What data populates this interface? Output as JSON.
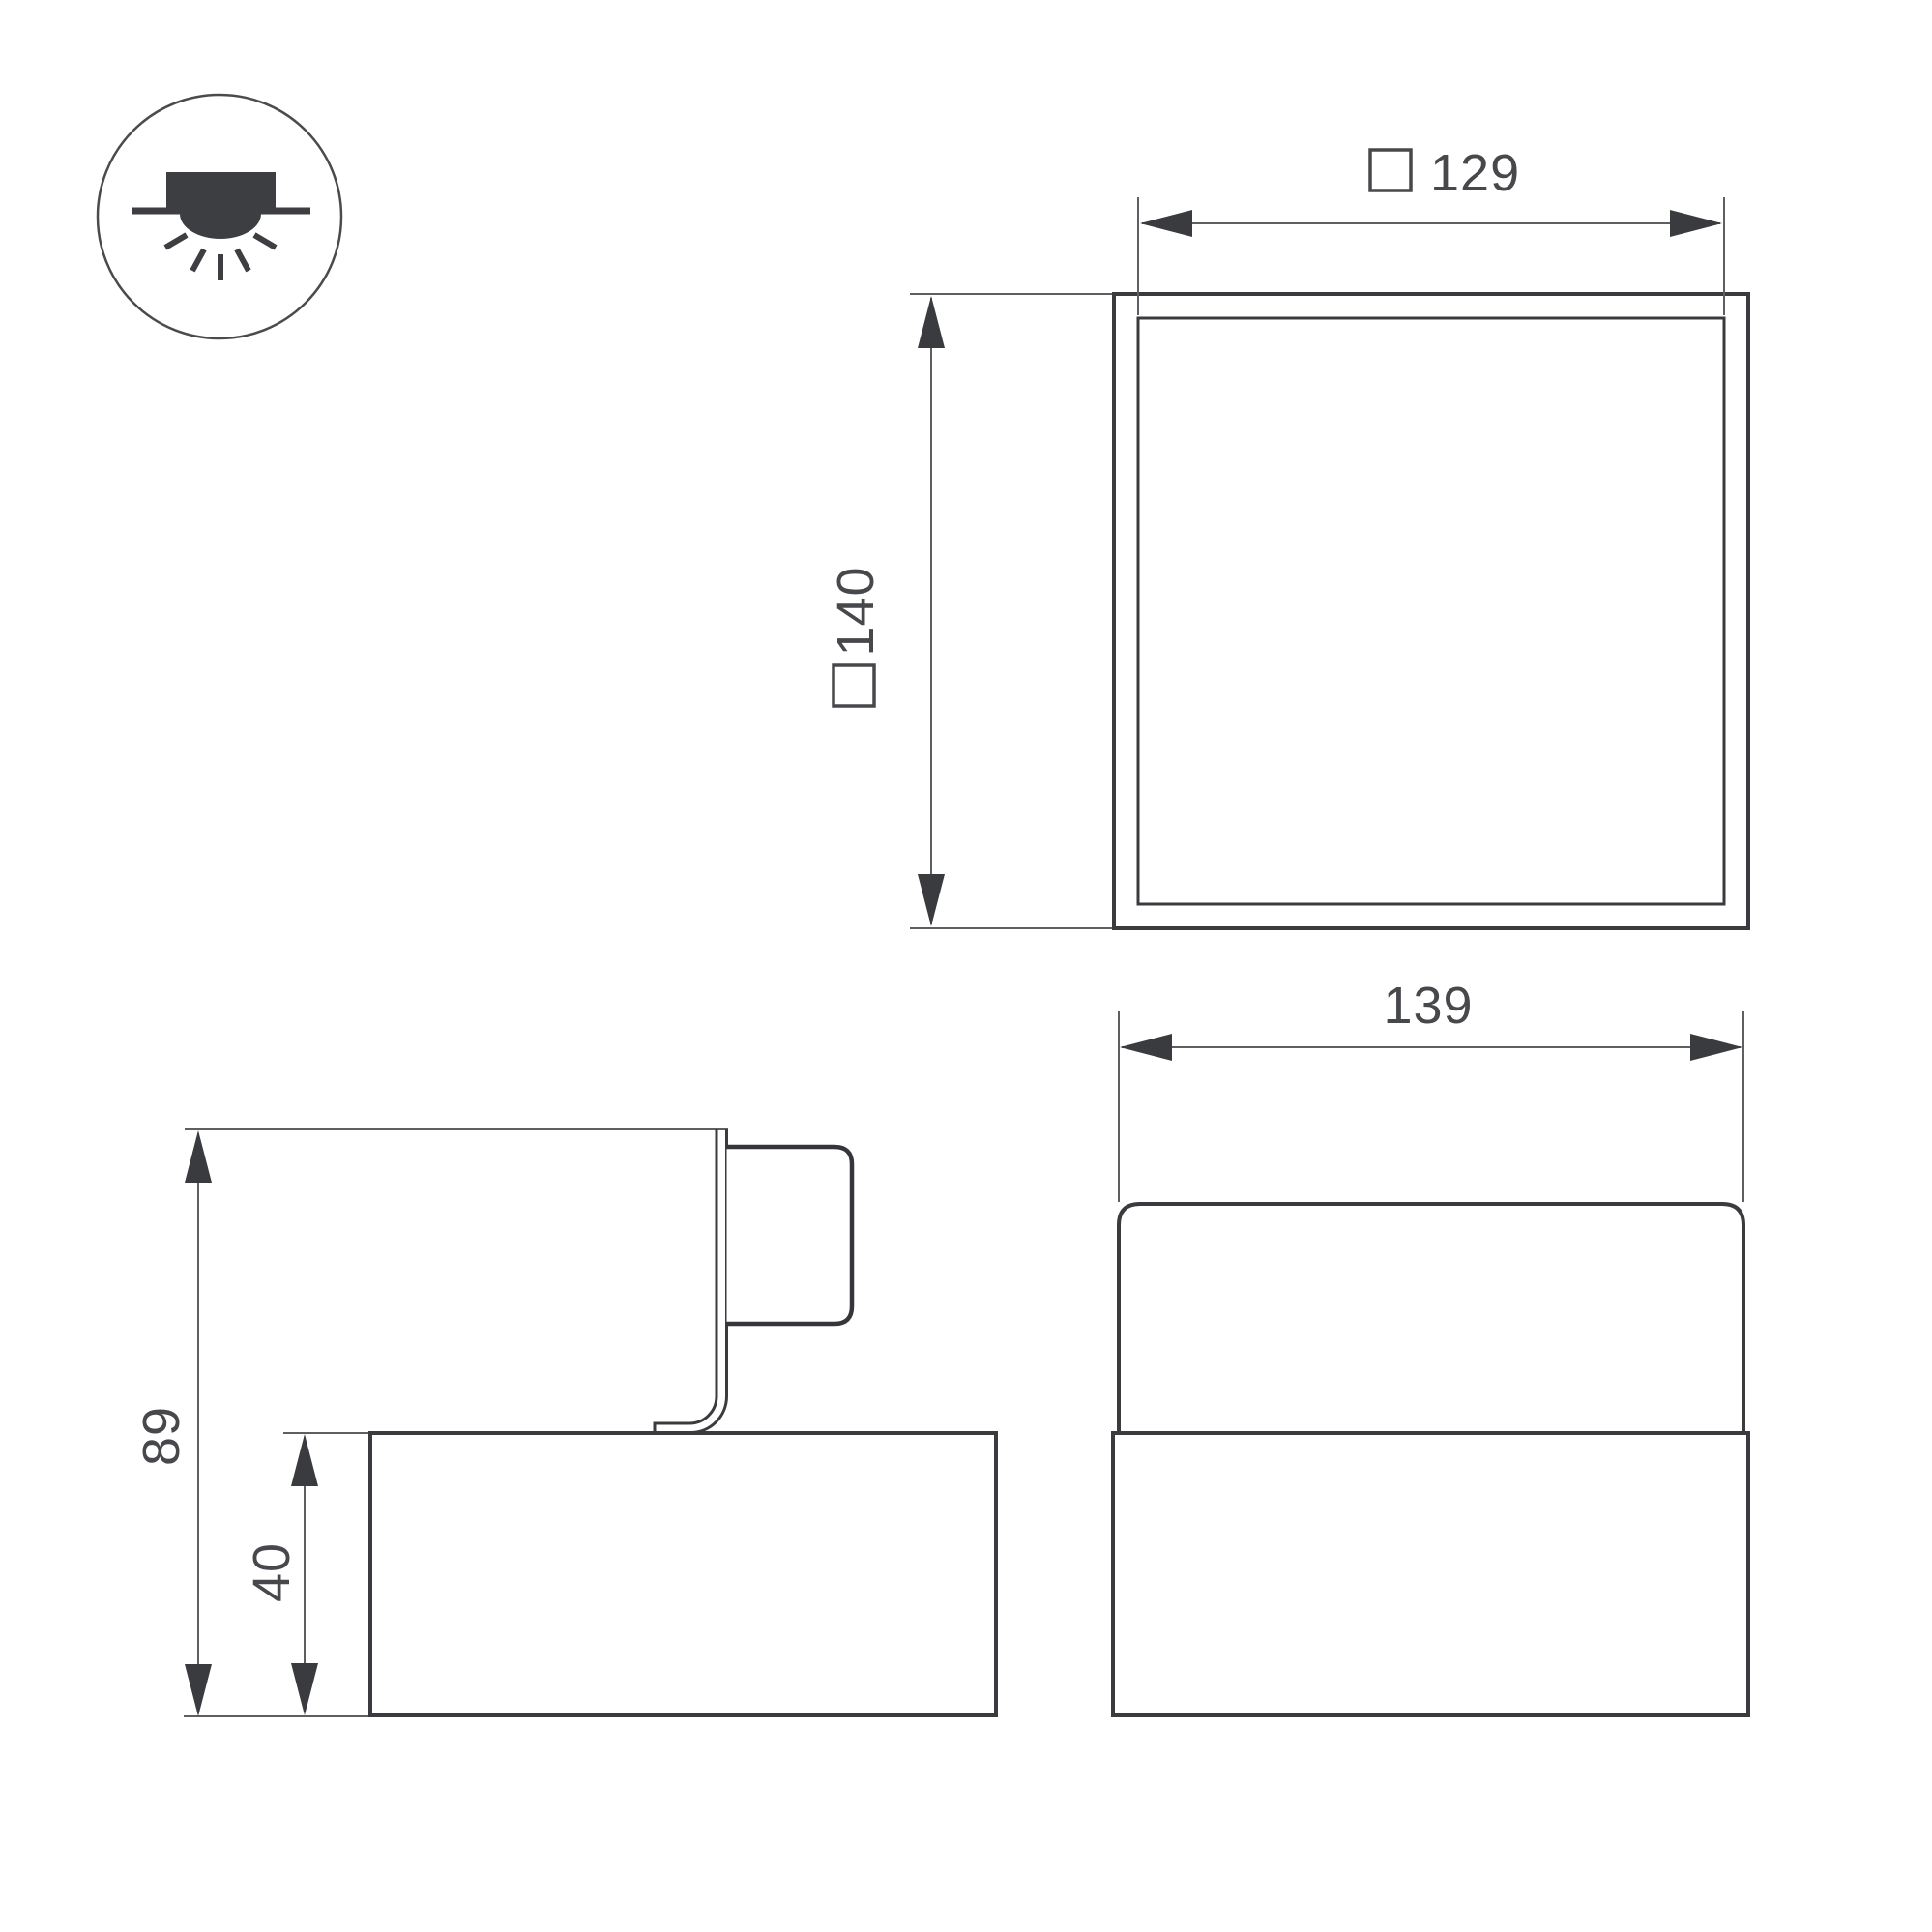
{
  "page": {
    "background": "#ffffff",
    "title": "Luminaire dimension drawing"
  },
  "palette": {
    "line": "#3a3b3f",
    "thin_line": "#5e5f63",
    "text": "#47484c"
  },
  "icons": {
    "mount_type_icon": "surface-mounted-ceiling-light-icon",
    "dimension_square_symbol": "□"
  },
  "dimensions": {
    "top_view_inner_width": {
      "prefix": "□",
      "value": "129"
    },
    "top_view_outer_size": {
      "prefix": "□",
      "value": "140"
    },
    "front_view_width": {
      "value": "139"
    },
    "side_view_total_height": {
      "value": "89"
    },
    "side_view_base_height": {
      "value": "40"
    }
  }
}
